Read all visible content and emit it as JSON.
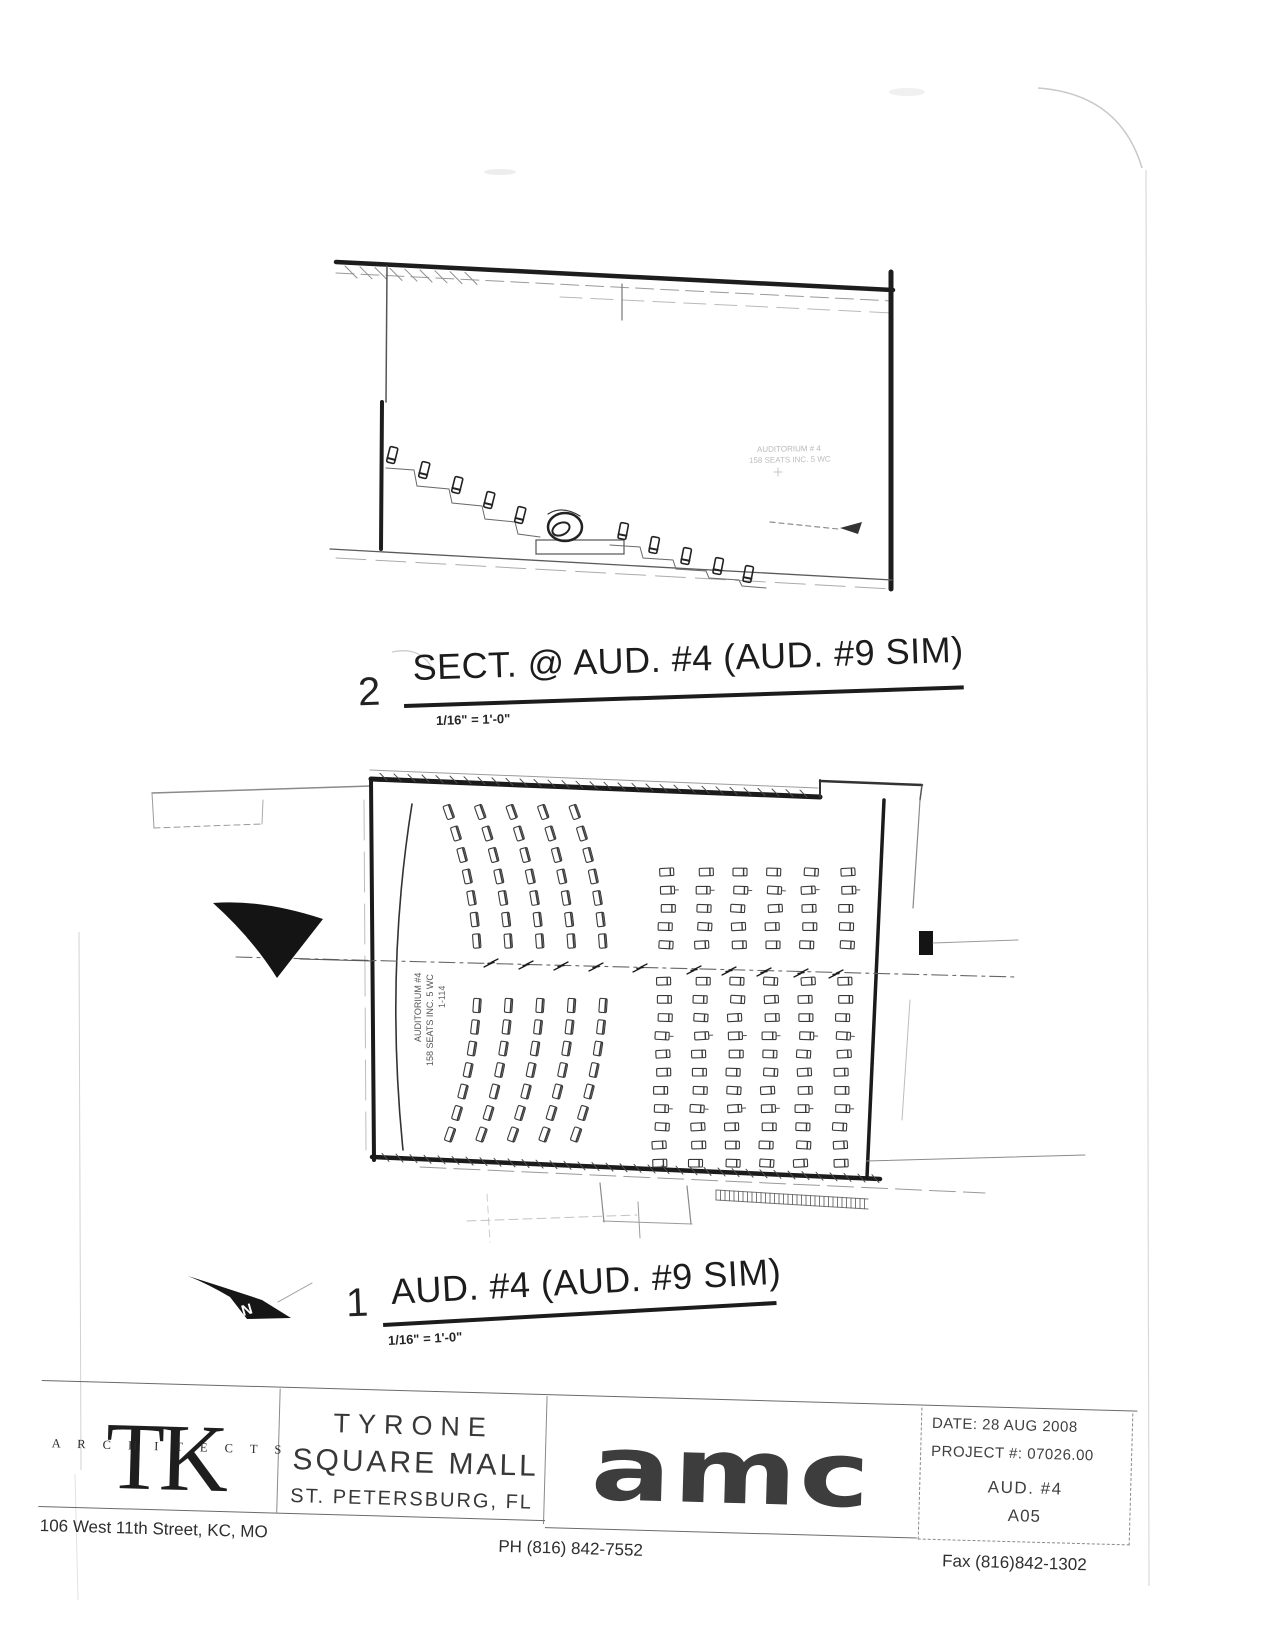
{
  "section_view": {
    "number": "2",
    "title": "SECT. @ AUD. #4 (AUD. #9 SIM)",
    "scale": "1/16\" = 1'-0\"",
    "annotation_line1": "AUDITORIUM # 4",
    "annotation_line2": "158 SEATS INC. 5 WC"
  },
  "plan_view": {
    "number": "1",
    "title": "AUD. #4 (AUD. #9 SIM)",
    "scale": "1/16\" = 1'-0\"",
    "north_label": "N",
    "room_label": {
      "line1": "AUDITORIUM #4",
      "line2": "158 SEATS INC. 5 WC",
      "line3": "1-114"
    }
  },
  "title_block": {
    "architect": {
      "initials": "TK",
      "name": "A R C H I T E C T S",
      "address": "106 West 11th Street,  KC, MO",
      "phone": "PH (816) 842-7552",
      "fax": "Fax (816)842-1302"
    },
    "project": {
      "line1": "TYRONE",
      "line2": "SQUARE MALL",
      "line3": "ST. PETERSBURG, FL"
    },
    "client_logo_text": "amc",
    "info": {
      "date": "DATE: 28 AUG 2008",
      "project_no": "PROJECT #: 07026.00",
      "sheet_title": "AUD. #4",
      "sheet_no": "A05"
    }
  },
  "colors": {
    "ink": "#1b1b1b",
    "faint": "#b8b8b8",
    "logo_gray": "#3d3d3d"
  }
}
